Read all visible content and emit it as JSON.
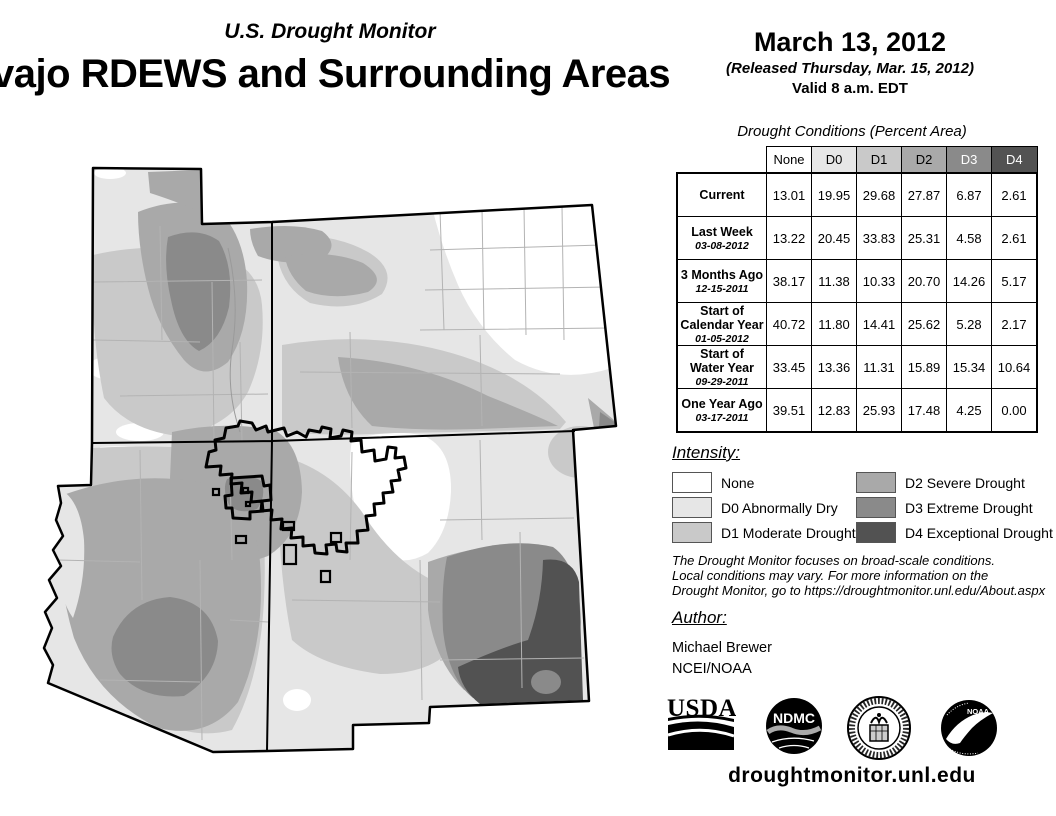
{
  "header": {
    "program_title": "U.S. Drought Monitor",
    "region_title": "vajo RDEWS and Surrounding Areas",
    "date": "March 13, 2012",
    "released": "(Released Thursday, Mar. 15, 2012)",
    "valid": "Valid 8 a.m. EDT"
  },
  "table": {
    "caption": "Drought Conditions (Percent Area)",
    "columns": [
      {
        "label": "None",
        "bg": "#ffffff",
        "fg": "#000000"
      },
      {
        "label": "D0",
        "bg": "#e6e6e6",
        "fg": "#000000"
      },
      {
        "label": "D1",
        "bg": "#c9c9c9",
        "fg": "#000000"
      },
      {
        "label": "D2",
        "bg": "#a9a9a9",
        "fg": "#000000"
      },
      {
        "label": "D3",
        "bg": "#8a8a8a",
        "fg": "#ffffff"
      },
      {
        "label": "D4",
        "bg": "#525252",
        "fg": "#ffffff"
      }
    ],
    "rows": [
      {
        "label_lines": [
          "Current"
        ],
        "date": "",
        "values": [
          "13.01",
          "19.95",
          "29.68",
          "27.87",
          "6.87",
          "2.61"
        ]
      },
      {
        "label_lines": [
          "Last Week"
        ],
        "date": "03-08-2012",
        "values": [
          "13.22",
          "20.45",
          "33.83",
          "25.31",
          "4.58",
          "2.61"
        ]
      },
      {
        "label_lines": [
          "3 Months Ago"
        ],
        "date": "12-15-2011",
        "values": [
          "38.17",
          "11.38",
          "10.33",
          "20.70",
          "14.26",
          "5.17"
        ]
      },
      {
        "label_lines": [
          "Start of",
          "Calendar Year"
        ],
        "date": "01-05-2012",
        "values": [
          "40.72",
          "11.80",
          "14.41",
          "25.62",
          "5.28",
          "2.17"
        ]
      },
      {
        "label_lines": [
          "Start of",
          "Water Year"
        ],
        "date": "09-29-2011",
        "values": [
          "33.45",
          "13.36",
          "11.31",
          "15.89",
          "15.34",
          "10.64"
        ]
      },
      {
        "label_lines": [
          "One Year Ago"
        ],
        "date": "03-17-2011",
        "values": [
          "39.51",
          "12.83",
          "25.93",
          "17.48",
          "4.25",
          "0.00"
        ]
      }
    ]
  },
  "legend": {
    "title": "Intensity:",
    "items": [
      {
        "label": "None",
        "color": "#ffffff"
      },
      {
        "label": "D0 Abnormally Dry",
        "color": "#e6e6e6"
      },
      {
        "label": "D1 Moderate Drought",
        "color": "#c9c9c9"
      },
      {
        "label": "D2 Severe Drought",
        "color": "#a9a9a9"
      },
      {
        "label": "D3 Extreme Drought",
        "color": "#8a8a8a"
      },
      {
        "label": "D4 Exceptional Drought",
        "color": "#525252"
      }
    ]
  },
  "notes": {
    "lines": [
      "The Drought Monitor focuses on broad-scale conditions.",
      "Local conditions may vary. For more information on the",
      "Drought Monitor, go to https://droughtmonitor.unl.edu/About.aspx"
    ]
  },
  "author": {
    "title": "Author:",
    "name": "Michael Brewer",
    "org": "NCEI/NOAA"
  },
  "footer": {
    "url": "droughtmonitor.unl.edu",
    "logo_usda_text": "USDA",
    "logo_ndmc_text": "NDMC",
    "logo_noaa_text": "NOAA"
  },
  "palette": {
    "none": "#ffffff",
    "d0": "#e6e6e6",
    "d1": "#c9c9c9",
    "d2": "#a9a9a9",
    "d3": "#8a8a8a",
    "d4": "#525252"
  }
}
